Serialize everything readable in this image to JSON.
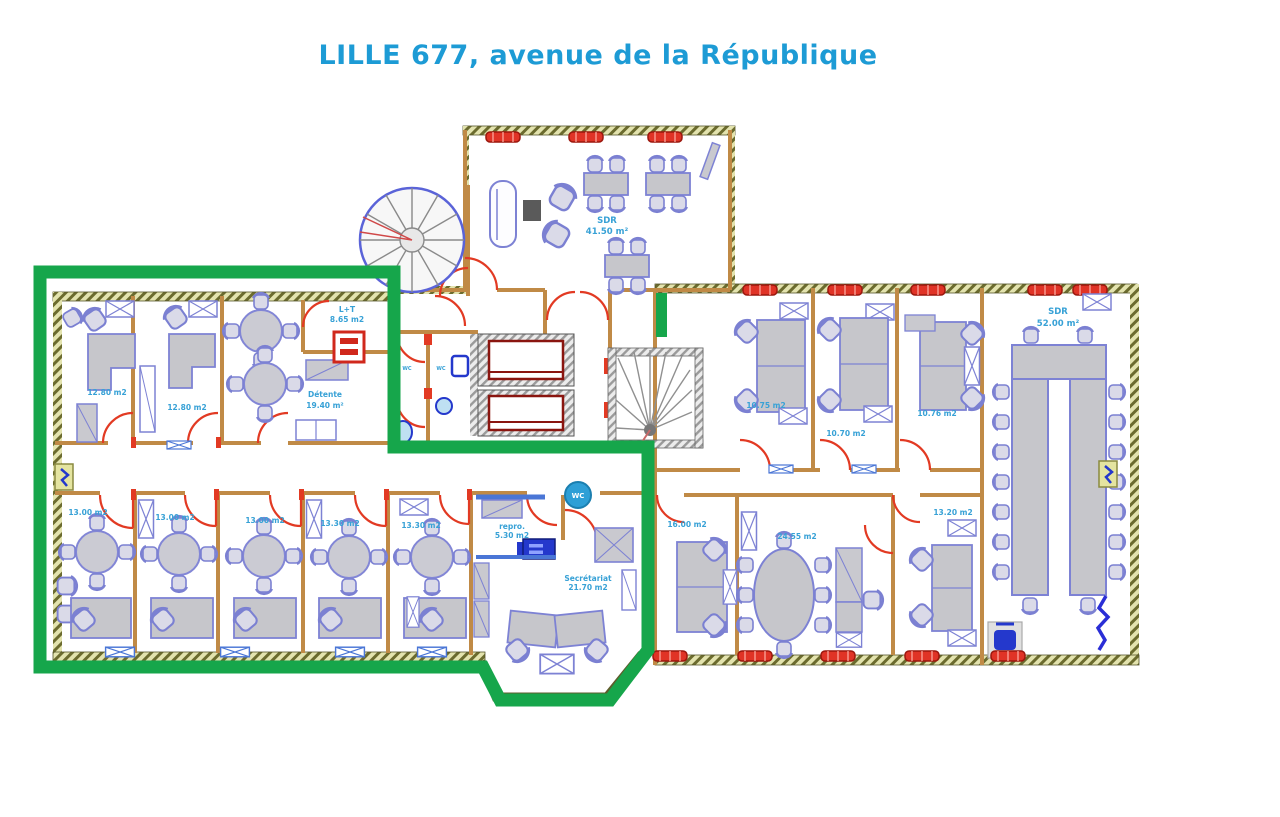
{
  "title": "LILLE 677, avenue de la République",
  "legend_colors": {
    "highlight_green": "#16a64b",
    "label_blue": "#37a1d6",
    "wall_tan": "#c08a46",
    "door_red": "#e23a23"
  },
  "plan": {
    "rooms": {
      "meeting_north": {
        "name": "SDR",
        "area": "41.50 m²"
      },
      "office_nw_1": {
        "area": "12.80 m2"
      },
      "office_nw_2": {
        "area": "12.80 m2"
      },
      "lounge": {
        "name": "Détente",
        "area": "19.40 m²"
      },
      "lt": {
        "name": "L+T",
        "area": "8.65 m2"
      },
      "office_sw_1": {
        "area": "13.00 m2"
      },
      "office_sw_2": {
        "area": "13.00 m2"
      },
      "office_sw_3": {
        "area": "13.00 m2"
      },
      "office_sw_4": {
        "area": "13.30 m2"
      },
      "office_sw_5": {
        "area": "13.30 m2"
      },
      "repro": {
        "name": "repro.",
        "area": "5.30 m2"
      },
      "secretariat": {
        "name": "Secrétariat",
        "area": "21.70 m2"
      },
      "wc": {
        "stamp": "WC",
        "label_1": "WC",
        "label_2": "WC"
      },
      "office_ne_1": {
        "area": "10.75 m2"
      },
      "office_ne_2": {
        "area": "10.70 m2"
      },
      "office_ne_3": {
        "area": "10.76 m2"
      },
      "meeting_east": {
        "name": "SDR",
        "area": "52.00 m²"
      },
      "office_se_1": {
        "area": "16.00 m2"
      },
      "office_se_2": {
        "area": "24.55 m2"
      },
      "office_se_3": {
        "area": "13.20 m2"
      }
    }
  }
}
